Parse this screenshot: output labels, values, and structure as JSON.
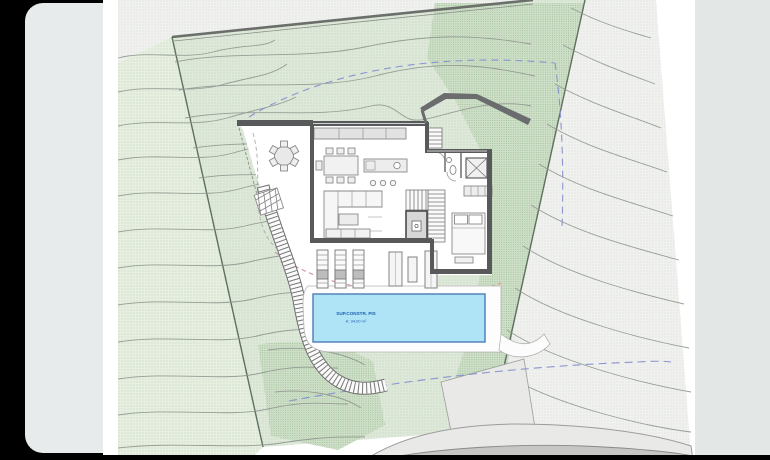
{
  "image_viewer": {
    "background": "#000000",
    "previous_photo_edge_color": "#e8ebeb",
    "next_photo_edge_color": "#e3e8e6"
  },
  "site_plan": {
    "pool_label": {
      "line1": "SUP.CONSTR. PIS",
      "line2": "A: 34,00 m²"
    },
    "colors": {
      "pool_fill": "#aee4f6",
      "pool_border": "#4a7cb8",
      "pool_text": "#1f5fae",
      "plot_green": "#dfe9da",
      "plot_green_dense": "#cfe0c8",
      "neighbor_green": "#e6efe0",
      "outside_land": "#f1f2ef",
      "contour_line": "#8f958f",
      "wall_dark": "#58595b",
      "setback_dashed": "#8a94cf",
      "alignment_dashed": "#d49090",
      "road_fill": "#c6c6c4",
      "sidewalk_fill": "#e9e9e7"
    }
  }
}
